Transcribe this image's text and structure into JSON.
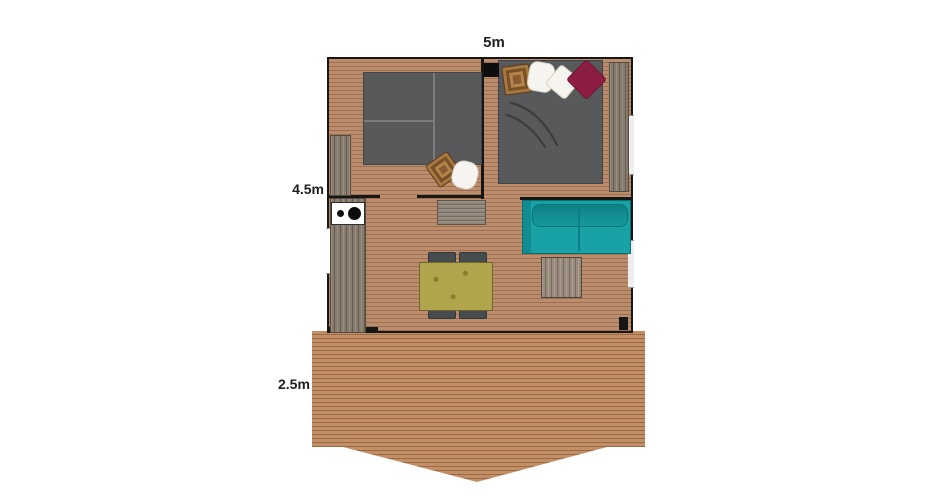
{
  "labels": {
    "width": "5m",
    "depth": "4.5m",
    "terrace_depth": "2.5m"
  },
  "palette": {
    "wall": "#161616",
    "floor": "#bc8d6c",
    "deck": "#c18e66",
    "bed": "#58595b",
    "sofa": "#18a2a6",
    "table": "#b0a44c",
    "chair": "#474c4e",
    "pouf": "#8a5a33",
    "pillow_white": "#f6f4ee",
    "pillow_burgundy": "#8e1d44",
    "stove": "#ffffff"
  },
  "furniture": [
    "twin-beds",
    "double-bed",
    "wardrobe-left",
    "wardrobe-right",
    "pouf",
    "pillows",
    "kitchen-counter",
    "two-burner-stove",
    "wall-shelf",
    "sofa",
    "coffee-table",
    "dining-table",
    "chairs",
    "terrace-deck"
  ]
}
